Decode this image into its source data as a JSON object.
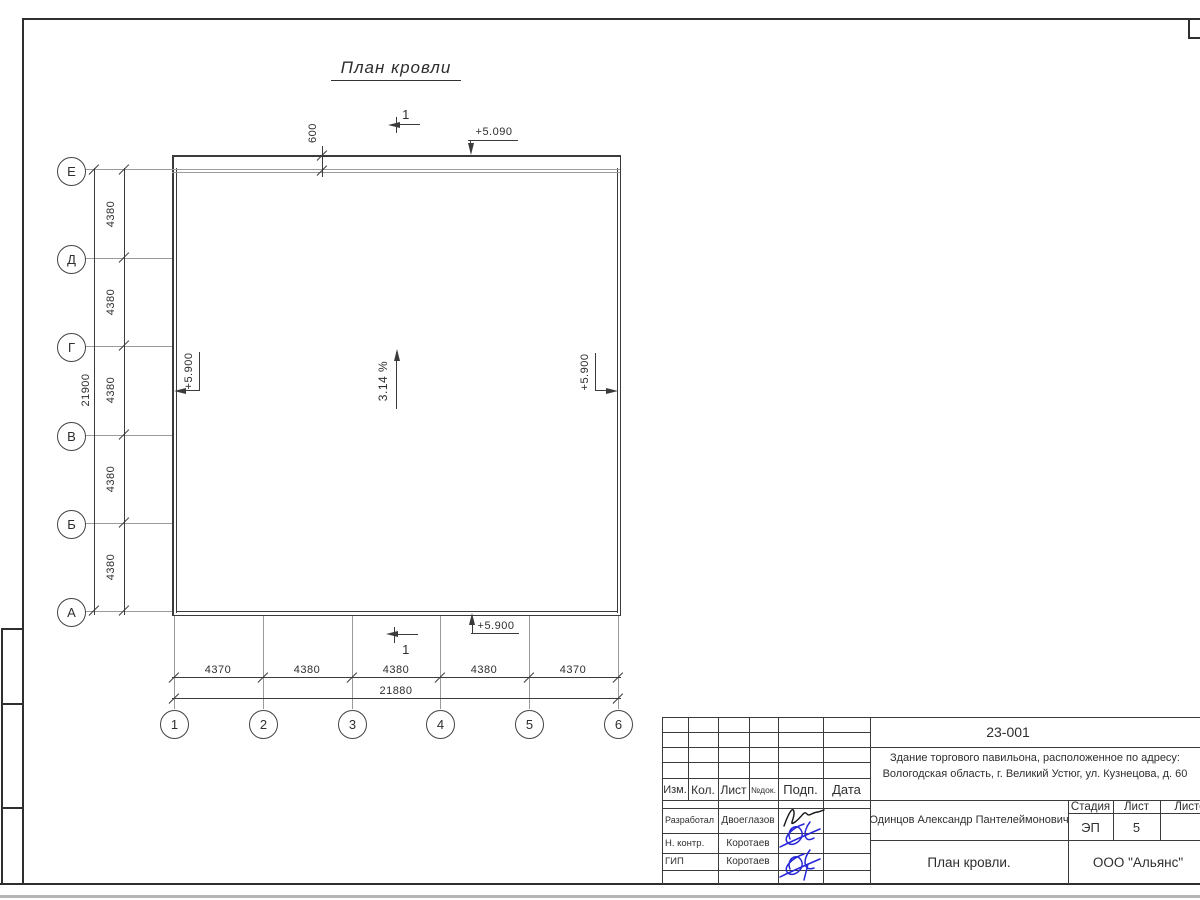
{
  "title": "План кровли",
  "axes": {
    "left": [
      "Е",
      "Д",
      "Г",
      "В",
      "Б",
      "А"
    ],
    "bottom": [
      "1",
      "2",
      "3",
      "4",
      "5",
      "6"
    ]
  },
  "dims": {
    "left_segments": [
      "4380",
      "4380",
      "4380",
      "4380",
      "4380"
    ],
    "left_total": "21900",
    "bottom_segments": [
      "4370",
      "4380",
      "4380",
      "4380",
      "4370"
    ],
    "bottom_total": "21880",
    "parapet_offset": "600"
  },
  "ann": {
    "elevation_top": "+5.090",
    "elevation_left": "+5.900",
    "elevation_right": "+5.900",
    "elevation_bottom": "+5.900",
    "slope": "3.14 %",
    "section_mark": "1"
  },
  "tb": {
    "doc_number": "23-001",
    "project_line1": "Здание торгового павильона, расположенное по адресу:",
    "project_line2": "Вологодская область, г. Великий Устюг, ул. Кузнецова, д. 60",
    "cols": [
      "Изм.",
      "Кол.",
      "Лист",
      "№док.",
      "Подп.",
      "Дата"
    ],
    "rows": [
      {
        "role": "Разработал",
        "name": "Двоеглазов"
      },
      {
        "role": "Н. контр.",
        "name": "Коротаев"
      },
      {
        "role": "ГИП",
        "name": "Коротаев"
      }
    ],
    "client": "Одинцов Александр Пантелеймонович",
    "stage_label": "Стадия",
    "sheet_label": "Лист",
    "sheets_label": "Листов",
    "stage": "ЭП",
    "sheet_number": "5",
    "sheet_title": "План кровли.",
    "company": "ООО \"Альянс\""
  },
  "colors": {
    "line": "#3b3b3b",
    "gray": "#9b9b9b",
    "signature_blue": "#2727d8",
    "signature_black": "#141414"
  }
}
